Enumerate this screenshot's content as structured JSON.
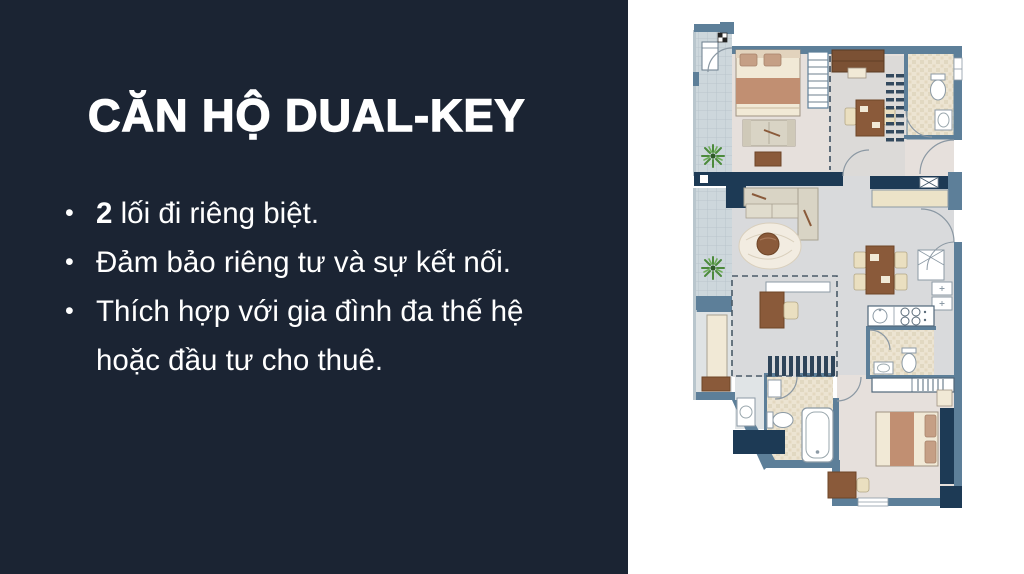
{
  "panel": {
    "background_color": "#1b2433",
    "text_color": "#ffffff",
    "title": "CĂN HỘ DUAL-KEY",
    "bullet_char": "•",
    "bullets": [
      {
        "bold": "2",
        "text": " lối đi riêng biệt."
      },
      {
        "bold": "",
        "text": "Đảm bảo riêng tư và sự kết nối."
      },
      {
        "bold": "",
        "text": "Thích hợp với gia đình đa thế hệ hoặc đầu tư cho thuê."
      }
    ]
  },
  "floorplan": {
    "description": "Dual-key apartment floor plan with two separate entrances, two units, balconies and stairs",
    "palette": {
      "wall": "#5d7f99",
      "wall_dark": "#1d3a55",
      "floor_warm": "#e6e0dc",
      "floor_cool": "#d9dadc",
      "floor_hall": "#dcdad8",
      "bath_tile": "#ece4d2",
      "bath_speckle": "#d9cdb2",
      "balcony_tile": "#cdd7dc",
      "wood": "#8a5a3a",
      "wood_dark": "#7b5134",
      "cream": "#f1e9d6",
      "tan": "#c59f85",
      "blanket": "#c18f72",
      "sofa": "#d9d4c5",
      "chair": "#eadfc0",
      "plant": "#4c8a3c"
    }
  }
}
